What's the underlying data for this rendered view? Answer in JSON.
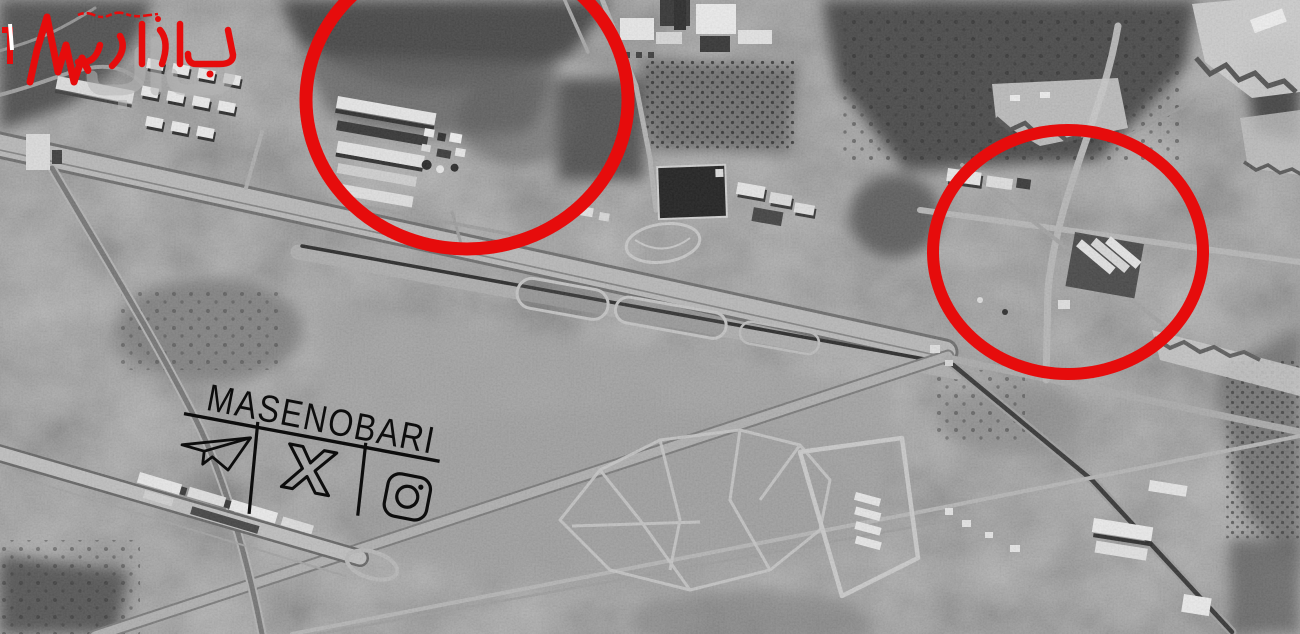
{
  "image": {
    "width": 1300,
    "height": 634,
    "style": "black-and-white satellite photograph of an airbase, annotated with red circles and watermarks"
  },
  "logo": {
    "small_text": "چگونه‌های بازار",
    "main_text": "بازار",
    "shadow_text": "نبض",
    "accent_color": "#e60c0c",
    "icon": "heartbeat-pulse-icon"
  },
  "watermark": {
    "text": "MASENOBARI",
    "color": "#0d0d0d",
    "rotation_deg": 11,
    "icons": [
      {
        "name": "telegram-icon"
      },
      {
        "name": "x-twitter-icon"
      },
      {
        "name": "instagram-icon"
      }
    ]
  },
  "highlight": {
    "color": "#e60c0c",
    "circles": [
      {
        "id": "highlight-circle-1",
        "cx": 467,
        "cy": 100,
        "rx": 161,
        "ry": 149,
        "stroke_width": 13
      },
      {
        "id": "highlight-circle-2",
        "cx": 1068,
        "cy": 252,
        "rx": 135,
        "ry": 122,
        "stroke_width": 12
      }
    ]
  },
  "scene": {
    "features": [
      "main runway with dark centerline running upper-left to lower-right",
      "secondary runway meeting at a junction",
      "rows of barracks buildings (top left)",
      "warehouse rows inside the left red circle",
      "industrial buildings (top center)",
      "dark rectangular reservoir",
      "orchard groves (dotted tree rows)",
      "crossroads compound inside the right red circle",
      "terraced hillside compounds with zigzag berms (right side)",
      "irregular field plots (bottom center)",
      "service strip with warehouses (bottom left)"
    ]
  }
}
